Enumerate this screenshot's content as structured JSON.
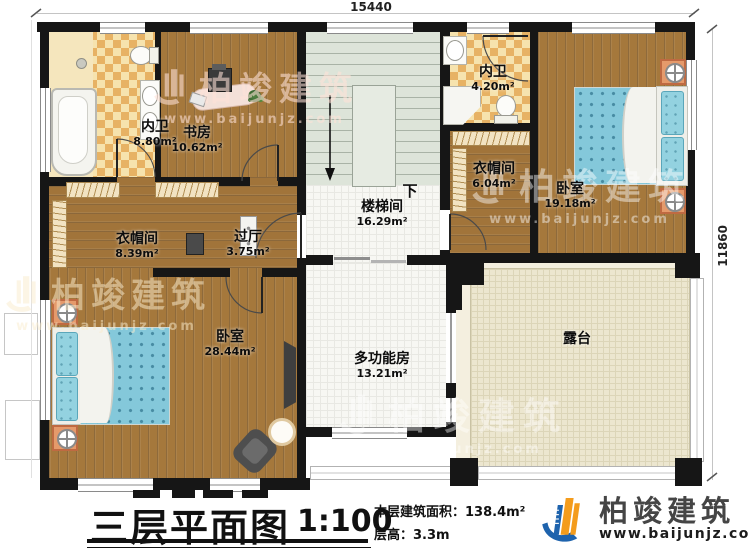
{
  "dimensions": {
    "top": "15440",
    "right": "11860"
  },
  "rooms": {
    "bath1": {
      "name": "内卫",
      "area": "8.80m²"
    },
    "study": {
      "name": "书房",
      "area": "10.62m²"
    },
    "stairhall": {
      "name": "楼梯间",
      "area": "16.29m²"
    },
    "bath2": {
      "name": "内卫",
      "area": "4.20m²"
    },
    "closet2": {
      "name": "衣帽间",
      "area": "6.04m²"
    },
    "bedroom2": {
      "name": "卧室",
      "area": "19.18m²"
    },
    "closet1": {
      "name": "衣帽间",
      "area": "8.39m²"
    },
    "hall": {
      "name": "过厅",
      "area": "3.75m²"
    },
    "bedroom1": {
      "name": "卧室",
      "area": "28.44m²"
    },
    "multi": {
      "name": "多功能房",
      "area": "13.21m²"
    },
    "terrace": {
      "name": "露台",
      "area": ""
    }
  },
  "stairs": {
    "down_label": "下"
  },
  "title": {
    "main": "三层平面图",
    "scale": "1:100",
    "area_line": "本层建筑面积：138.4m²",
    "height_line": "层高：3.3m"
  },
  "logo": {
    "name": "柏竣建筑",
    "url": "www.baijunjz.com"
  },
  "watermark": {
    "name": "柏竣建筑",
    "url": "www.baijunjz.com"
  },
  "colors": {
    "wall": "#161616",
    "wood": "#a5783c",
    "tile_cream": "#f6e3ae",
    "tile_orange": "#e7b264",
    "stair": "#dde4d9",
    "terrace": "#ece6cf",
    "bed_blue": "#84c8da",
    "nightstand_orange": "#e59a6b",
    "logo_blue": "#1e63ad",
    "logo_orange": "#f49c1c"
  }
}
